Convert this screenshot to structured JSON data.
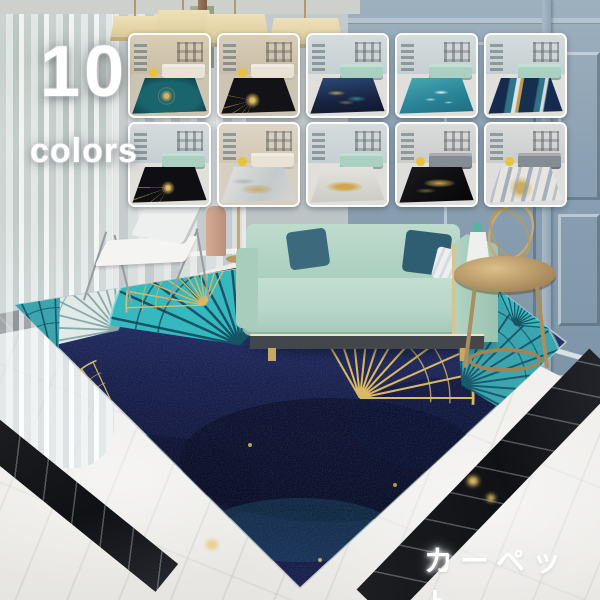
{
  "badge": {
    "number": "10",
    "label": "colors"
  },
  "caption": "カーペット",
  "colors": {
    "gold": "#d8b75f",
    "mint": "#b7d6c9",
    "teal": "#2fb7bd",
    "navy": "#1a2150",
    "wall_blue": "#8ba0b2",
    "marble_white": "#eceae6",
    "marble_black": "#101115",
    "lamp_cream": "#e9dcb8",
    "text_white": "#ffffff"
  },
  "thumbnails": {
    "count": 10,
    "items": [
      {
        "name": "teal-gold-medallion",
        "wall": "background:linear-gradient(180deg,#d9cdb6,#c8bca4)",
        "floor": "background:#cdc5b4",
        "sofa": "background:#e8e3d5",
        "chair": "background:#e8c23a",
        "rug": "background:radial-gradient(circle at 46% 50%, #d8b35c 0 5%, rgba(216,179,92,.45) 9%, transparent 15%), radial-gradient(circle at 46% 50%, transparent 0 17%, rgba(216,179,92,.35) 18% 19%, transparent 20%), radial-gradient(ellipse at 50% 55%, #1a646e 0 55%, #0d3d49 90%), #0d3d49"
      },
      {
        "name": "black-gold-sunburst-beige-room",
        "wall": "background:linear-gradient(180deg,#d9cdb6,#c8bca4)",
        "floor": "background:#cdc5b4",
        "sofa": "background:#e8e3d5",
        "chair": "background:#e8c23a",
        "rug": "background:radial-gradient(circle at 42% 62%, #e3bd63 0 4%, rgba(227,189,99,.55) 9%, transparent 16%), conic-gradient(from 200deg at 42% 62%, rgba(222,184,96,.55) 0 2deg, transparent 2deg 18deg, rgba(222,184,96,.55) 18deg 20deg, transparent 20deg 36deg, rgba(222,184,96,.55) 36deg 38deg, transparent 38deg 54deg, rgba(222,184,96,.55) 54deg 56deg, transparent 56deg 80deg, rgba(222,184,96,.45) 80deg 82deg, transparent 82deg 360deg), linear-gradient(118deg, #2c8a92 0 12%, #121217 12.5%)"
      },
      {
        "name": "navy-gold-ginkgo",
        "wall": "background:linear-gradient(180deg,#d6dcdd,#c4ced1)",
        "floor": "background:#e0dfdb",
        "sofa": "background:#a9d0c1",
        "chair": "display:none",
        "rug": "background:radial-gradient(ellipse 18% 10% at 35% 42%, rgba(216,179,92,.85), transparent 70%), radial-gradient(ellipse 20% 12% at 62% 58%, rgba(77,196,201,.55), transparent 70%), radial-gradient(ellipse 16% 9% at 48% 68%, rgba(216,179,92,.5), transparent 70%), linear-gradient(175deg, #2a4a77 0%, #18233f 60%, #10182e 100%)"
      },
      {
        "name": "teal-ocean-white",
        "wall": "background:linear-gradient(180deg,#d6dcdd,#c4ced1)",
        "floor": "background:#e0dfdb",
        "sofa": "background:#a9d0c1",
        "chair": "display:none",
        "rug": "background:radial-gradient(ellipse 16% 9% at 56% 40%, rgba(255,255,255,.9), transparent 65%), radial-gradient(ellipse 12% 7% at 42% 60%, rgba(255,255,255,.7), transparent 65%), radial-gradient(ellipse 10% 6% at 66% 68%, rgba(255,255,255,.6), transparent 65%), linear-gradient(165deg, #49aab6 0%, #2a8397 55%, #1d6c82 100%)"
      },
      {
        "name": "navy-teal-gold-stripes",
        "wall": "background:linear-gradient(180deg,#d6dcdd,#c4ced1)",
        "floor": "background:#e0dfdb",
        "sofa": "background:#a9d0c1",
        "chair": "display:none",
        "rug": "background:linear-gradient(100deg, #152a4e 0 26%, #2e7389 28% 35%, #d9e4e4 36% 40%, #c49a4e 41% 44%, #15304f 45% 62%, #2e7389 64% 70%, #cfdcdc 71% 74%, #152a4e 76%)"
      },
      {
        "name": "black-gold-sunburst-mint-room",
        "wall": "background:linear-gradient(180deg,#d6dcdd,#c4ced1)",
        "floor": "background:#e0dfdb",
        "sofa": "background:#a9d0c1",
        "chair": "display:none",
        "rug": "background:linear-gradient(150deg, #2c8a92 0 10%, rgba(44,138,146,0) 10.5%), radial-gradient(circle at 48% 58%, #e3bd63 0 4%, rgba(227,189,99,.5) 9%, transparent 16%), conic-gradient(from 210deg at 48% 58%, rgba(222,184,96,.5) 0 2deg, transparent 2deg 20deg, rgba(222,184,96,.5) 20deg 22deg, transparent 22deg 40deg, rgba(222,184,96,.5) 40deg 42deg, transparent 42deg 60deg, rgba(222,184,96,.5) 60deg 62deg, transparent 62deg 360deg), #0e0e13"
      },
      {
        "name": "ivory-gray-gold-abstract",
        "wall": "background:linear-gradient(180deg,#ded5c6,#cfc6b5)",
        "floor": "background:#d7d0c2",
        "sofa": "background:#e8e3d5",
        "chair": "background:#e8c23a",
        "rug": "background:radial-gradient(ellipse 30% 18% at 48% 62%, rgba(203,162,78,.8), rgba(203,162,78,.25) 60%, transparent 75%), radial-gradient(ellipse 24% 12% at 30% 40%, rgba(130,150,165,.5), transparent 70%), linear-gradient(120deg, #e6e4de 0%, #c3c9cc 60%, #d8d6d0 100%)"
      },
      {
        "name": "light-gray-gold-marble",
        "wall": "background:linear-gradient(180deg,#d6dcdd,#c4ced1)",
        "floor": "background:#e0dfdb",
        "sofa": "background:#a9d0c1",
        "chair": "display:none",
        "rug": "background:radial-gradient(ellipse 34% 20% at 46% 55%, #cfa54e 0 30%, rgba(207,165,78,.45) 55%, transparent 75%), linear-gradient(180deg, #e4e2dc, #cbcbc6)"
      },
      {
        "name": "black-gold-marble",
        "wall": "background:linear-gradient(180deg,#dadcda,#c9cccb)",
        "floor": "background:#dedfdd",
        "sofa": "background:#868c94",
        "chair": "background:#e8c23a",
        "rug": "background:radial-gradient(ellipse 30% 16% at 54% 45%, rgba(214,172,80,.95), rgba(214,172,80,.3) 55%, transparent 72%), radial-gradient(ellipse 20% 10% at 36% 66%, rgba(214,172,80,.5), transparent 70%), linear-gradient(140deg, #1b1b20, #050507)"
      },
      {
        "name": "white-blue-gold-abstract",
        "wall": "background:linear-gradient(180deg,#dadcda,#c9cccb)",
        "floor": "background:#dedfdd",
        "sofa": "background:#868c94",
        "chair": "background:#e8c23a",
        "rug": "background:repeating-linear-gradient(104deg, rgba(142,158,178,.75) 0 4px, rgba(142,158,178,0) 4px 10px, rgba(142,158,178,.5) 10px 13px, rgba(142,158,178,0) 13px 20px), radial-gradient(circle at 44% 58%, rgba(205,165,75,.9) 0 10%, rgba(205,165,75,.35) 18%, transparent 26%), #e7e5df"
      }
    ]
  }
}
